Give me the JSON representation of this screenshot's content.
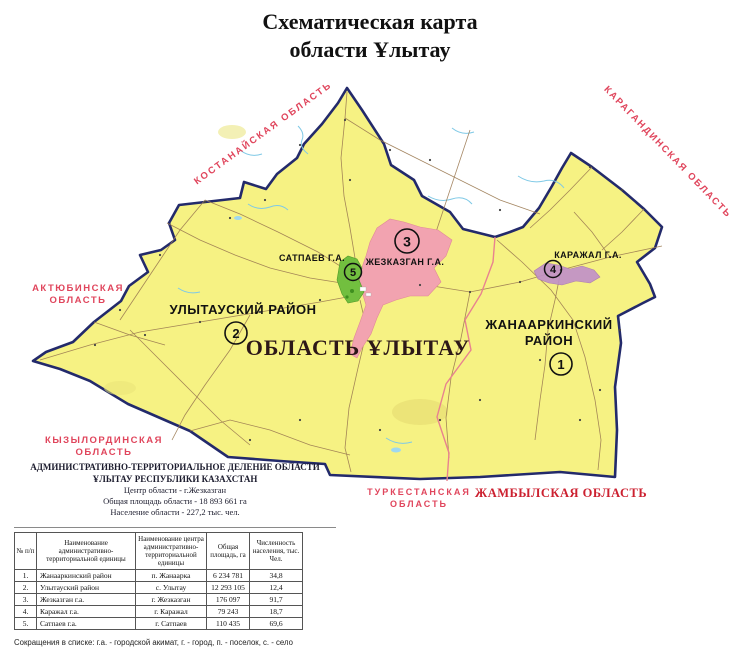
{
  "title": {
    "line1": "Схематическая карта",
    "line2": "области Ұлытау"
  },
  "neighbors": {
    "kostanay": "КОСТАНАЙСКАЯ ОБЛАСТЬ",
    "karaganda": "КАРАГАНДИНСКАЯ ОБЛАСТЬ",
    "aktobe_line1": "АКТЮБИНСКАЯ",
    "aktobe_line2": "ОБЛАСТЬ",
    "kyzylorda_line1": "КЫЗЫЛОРДИНСКАЯ",
    "kyzylorda_line2": "ОБЛАСТЬ",
    "turkestan_line1": "ТУРКЕСТАНСКАЯ",
    "turkestan_line2": "ОБЛАСТЬ",
    "zhambyl": "ЖАМБЫЛСКАЯ ОБЛАСТЬ"
  },
  "region": {
    "name": "ОБЛАСТЬ ҰЛЫТАУ",
    "districts": {
      "ulytau": "УЛЫТАУСКИЙ РАЙОН",
      "zhanaarka_line1": "ЖАНААРКИНСКИЙ",
      "zhanaarka_line2": "РАЙОН",
      "satpaev": "САТПАЕВ Г.А.",
      "zhezkazgan": "ЖЕЗКАЗГАН Г.А.",
      "karazhal": "КАРАЖАЛ Г.А."
    },
    "markers": {
      "m1": "1",
      "m2": "2",
      "m3": "3",
      "m4": "4",
      "m5": "5"
    }
  },
  "info": {
    "heading1": "АДМИНИСТРАТИВНО-ТЕРРИТОРИАЛЬНОЕ ДЕЛЕНИЕ ОБЛАСТИ",
    "heading2": "ҰЛЫТАУ РЕСПУБЛИКИ КАЗАХСТАН",
    "center": "Центр области - г.Жезказган",
    "area": "Общая площадь области - 18 893 661 га",
    "population": "Население области - 227,2 тыс. чел."
  },
  "table": {
    "headers": [
      "№ п/п",
      "Наименование административно-территориальной единицы",
      "Наименование центра административно-территориальной единицы",
      "Общая площадь, га",
      "Численность населения, тыс. Чел."
    ],
    "rows": [
      [
        "1.",
        "Жанааркинский район",
        "п. Жанаарка",
        "6 234 781",
        "34,8"
      ],
      [
        "2.",
        "Улытауский район",
        "с. Улытау",
        "12 293 105",
        "12,4"
      ],
      [
        "3.",
        "Жезказган г.а.",
        "г. Жезказган",
        "176 097",
        "91,7"
      ],
      [
        "4.",
        "Каражал г.а.",
        "г. Каражал",
        "79 243",
        "18,7"
      ],
      [
        "5.",
        "Сатпаев г.а.",
        "г. Сатпаев",
        "110 435",
        "69,6"
      ]
    ]
  },
  "footnote": "Сокращения в списке: г.а. - городской акимат, г. - город, п. - поселок, с. - село",
  "colors": {
    "map_fill": "#f6f283",
    "map_border": "#232a6b",
    "zhezkazgan_area": "#f2a3b0",
    "karazhal_area": "#c08fc9",
    "satpaev_area": "#72bf3f",
    "neighbor_label": "#e0455c",
    "zhambyl_label": "#cc2130",
    "district_boundary": "#e8828f",
    "road": "#9b7a52",
    "river": "#7fc9e6"
  }
}
